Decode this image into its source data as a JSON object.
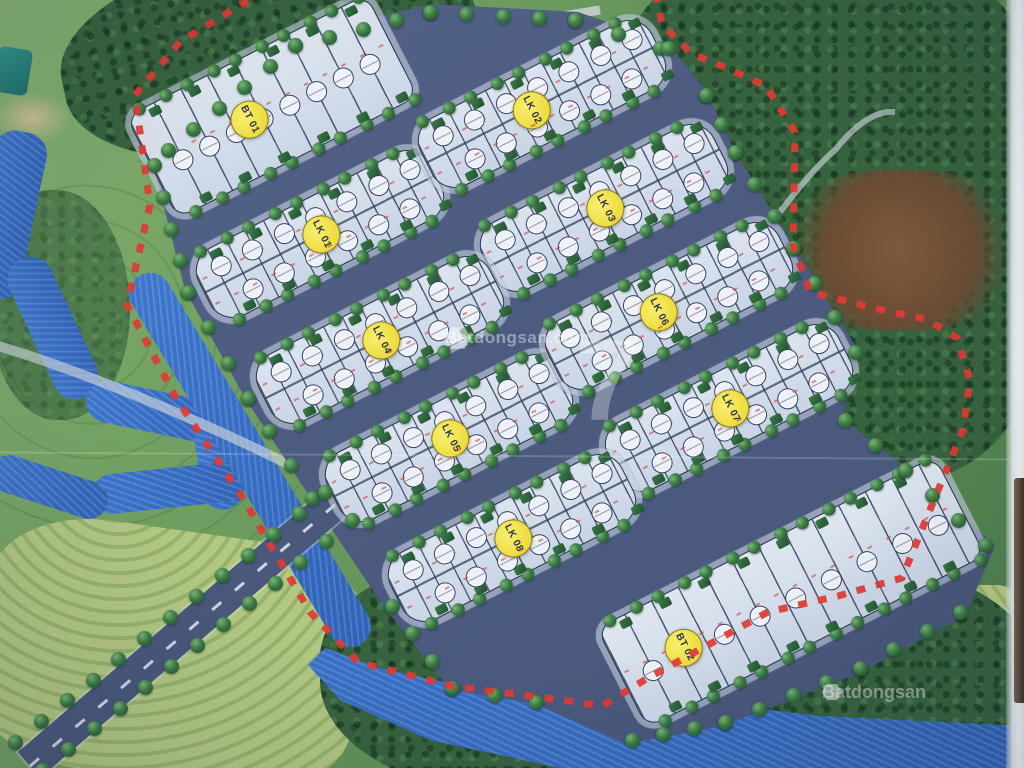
{
  "map": {
    "origin": {
      "x": 510,
      "y": 360
    },
    "rotation_deg": -27,
    "blocks": [
      {
        "id": "bt-01",
        "label": "BT 01",
        "type": "bt",
        "x": -97,
        "y": -334,
        "len": 270,
        "wid": 115,
        "frac": 0.4,
        "plots": 8
      },
      {
        "id": "lk-01",
        "label": "LK 01",
        "type": "lk",
        "x": -112,
        "y": -199,
        "len": 260,
        "wid": 76,
        "frac": 0.5,
        "plots": 14
      },
      {
        "id": "lk-02",
        "label": "LK 02",
        "type": "lk",
        "x": 145,
        "y": -213,
        "len": 260,
        "wid": 76,
        "frac": 0.45,
        "plots": 14
      },
      {
        "id": "lk-03",
        "label": "LK 03",
        "type": "lk",
        "x": 153,
        "y": -93,
        "len": 260,
        "wid": 76,
        "frac": 0.5,
        "plots": 14
      },
      {
        "id": "lk-04",
        "label": "LK 04",
        "type": "lk",
        "x": -107,
        "y": -77,
        "len": 260,
        "wid": 76,
        "frac": 0.5,
        "plots": 14
      },
      {
        "id": "lk-05",
        "label": "LK 05",
        "type": "lk",
        "x": -90,
        "y": 42,
        "len": 260,
        "wid": 76,
        "frac": 0.5,
        "plots": 14
      },
      {
        "id": "lk-06",
        "label": "LK 06",
        "type": "lk",
        "x": 166,
        "y": 24,
        "len": 260,
        "wid": 76,
        "frac": 0.45,
        "plots": 14
      },
      {
        "id": "lk-07",
        "label": "LK 07",
        "type": "lk",
        "x": 173,
        "y": 142,
        "len": 260,
        "wid": 76,
        "frac": 0.5,
        "plots": 14
      },
      {
        "id": "lk-08",
        "label": "LK 08",
        "type": "lk",
        "x": -79,
        "y": 159,
        "len": 260,
        "wid": 76,
        "frac": 0.5,
        "plots": 14
      },
      {
        "id": "bt-02",
        "label": "BT 02",
        "type": "bt",
        "x": 145,
        "y": 334,
        "len": 380,
        "wid": 112,
        "frac": 0.18,
        "plots": 9
      }
    ],
    "colors": {
      "road": "#4d5c80",
      "plot_fill": "#d3dcea",
      "boundary_red": "#e13a33",
      "water_blue": "#3d76cc",
      "label_yellow": "#eedc3e",
      "tree_green": "#2f6b3a"
    },
    "watermarks": {
      "center_text": "Batdongsan.com",
      "center_big_digit": "7",
      "corner_text": "Batdongsan"
    }
  }
}
